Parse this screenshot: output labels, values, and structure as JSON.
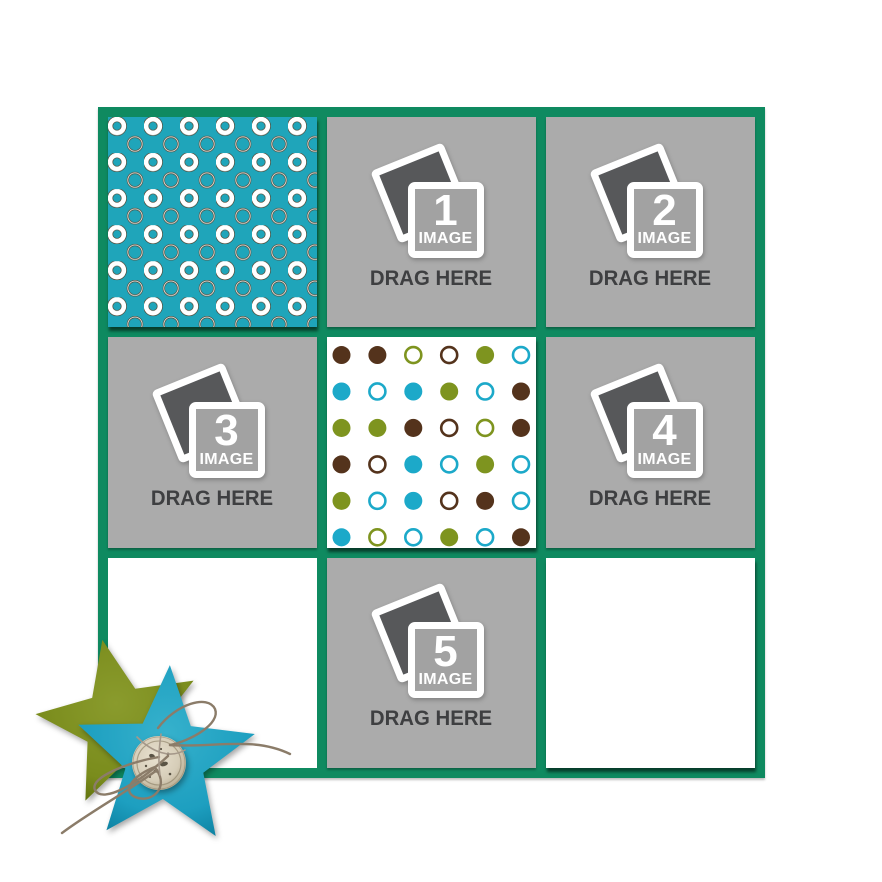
{
  "page": {
    "background": "#ffffff",
    "kind": "photo collage drag-and-drop template"
  },
  "frame": {
    "color": "#0f8a60",
    "rows": 3,
    "cols": 3,
    "border_px": 10
  },
  "colors": {
    "slot_gray": "#ababab",
    "drag_text": "#3e3f41",
    "photo_dark": "#57585a",
    "white": "#ffffff"
  },
  "slots": [
    {
      "number": "1",
      "image_label": "IMAGE",
      "drag_label": "DRAG HERE",
      "grid_position": "row 1, col 2"
    },
    {
      "number": "2",
      "image_label": "IMAGE",
      "drag_label": "DRAG HERE",
      "grid_position": "row 1, col 3"
    },
    {
      "number": "3",
      "image_label": "IMAGE",
      "drag_label": "DRAG HERE",
      "grid_position": "row 2, col 1"
    },
    {
      "number": "4",
      "image_label": "IMAGE",
      "drag_label": "DRAG HERE",
      "grid_position": "row 2, col 3"
    },
    {
      "number": "5",
      "image_label": "IMAGE",
      "drag_label": "DRAG HERE",
      "grid_position": "row 3, col 2"
    }
  ],
  "patterned_papers": {
    "teal_rings": {
      "grid_position": "row 1, col 1",
      "background": "#1fa5ba",
      "ring_color": "#ffffff",
      "outline_color": "#4e4936"
    },
    "polka_dots": {
      "grid_position": "row 2, col 2",
      "background": "#ffffff",
      "colors": {
        "br": "#54331c",
        "ol": "#7e941f",
        "te": "#1ca9c9"
      },
      "legend": "token = color(br/ol/te) - style(f=filled, o=outline)",
      "grid": [
        [
          "br-f",
          "br-f",
          "ol-o",
          "br-o",
          "ol-f",
          "te-o"
        ],
        [
          "te-f",
          "te-o",
          "te-f",
          "ol-f",
          "te-o",
          "br-f"
        ],
        [
          "ol-f",
          "ol-f",
          "br-f",
          "br-o",
          "ol-o",
          "br-f"
        ],
        [
          "br-f",
          "br-o",
          "te-f",
          "te-o",
          "ol-f",
          "te-o"
        ],
        [
          "ol-f",
          "te-o",
          "te-f",
          "br-o",
          "br-f",
          "te-o"
        ],
        [
          "te-f",
          "ol-o",
          "te-o",
          "ol-f",
          "te-o",
          "br-f"
        ]
      ]
    },
    "lattice": {
      "grid_position": "row 3, col 3",
      "background": "#ffffff",
      "line_color": "#3b8a55"
    }
  },
  "empty_cell": {
    "grid_position": "row 3, col 1",
    "background": "#ffffff"
  },
  "decoration": {
    "type": "star-cluster",
    "back_star_color": "#7e8f1f",
    "front_star_color": "#1d9fc0",
    "button_color": "#d6cdb8",
    "twine_color": "#8b7c69"
  }
}
